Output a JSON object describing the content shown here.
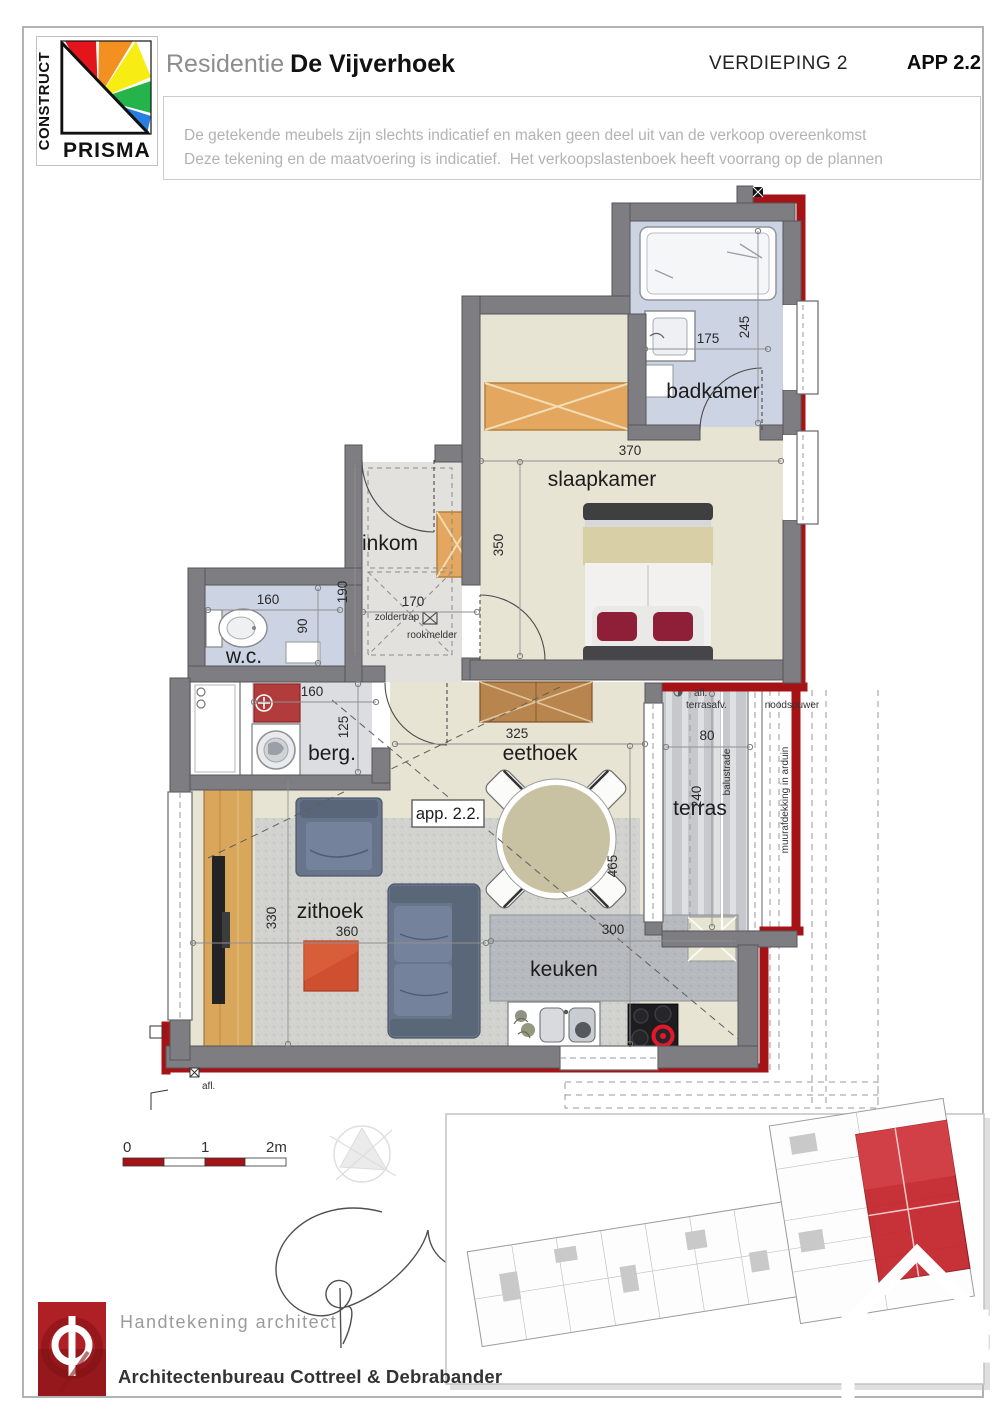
{
  "header": {
    "logo": {
      "construct": "CONSTRUCT",
      "prisma": "PRISMA"
    },
    "title_prefix": "Residentie",
    "title_name": "De Vijverhoek",
    "floor": "VERDIEPING 2",
    "apartment": "APP 2.2",
    "disclaimer_line1": "De getekende meubels zijn slechts indicatief en maken geen deel uit van de verkoop overeenkomst",
    "disclaimer_line2": "Deze tekening en de maatvoering is indicatief.  Het verkoopslastenboek heeft voorrang op de plannen"
  },
  "plan": {
    "apartment_tag": "app. 2.2.",
    "rooms": {
      "badkamer": "badkamer",
      "slaapkamer": "slaapkamer",
      "inkom": "inkom",
      "wc": "w.c.",
      "berg": "berg.",
      "eethoek": "eethoek",
      "terras": "terras",
      "zithoek": "zithoek",
      "keuken": "keuken"
    },
    "dims": {
      "badkamer_w": "175",
      "badkamer_d": "245",
      "slaapkamer_w": "370",
      "slaapkamer_d": "350",
      "inkom_d": "190",
      "inkom_w": "170",
      "wc_w": "160",
      "wc_d": "90",
      "berg_w": "160",
      "berg_d": "125",
      "eethoek_w": "325",
      "living_d": "465",
      "terras_w": "80",
      "terras_d": "240",
      "zithoek_d": "330",
      "zithoek_w": "360",
      "keuken_w": "300"
    },
    "annotations": {
      "zoldertrap": "zoldertrap",
      "rookmelder": "rookmelder",
      "balustrade": "balustrade",
      "muurafdekking": "muurafdekking in arduin",
      "noodspuwer": "noodspuwer",
      "afl_terras_1": "afl.",
      "afl_terras_2": "terrasafv.",
      "afl_bottom": "afl."
    }
  },
  "footer": {
    "scale": {
      "t0": "0",
      "t1": "1",
      "t2": "2m"
    },
    "signature_label": "Handtekening architect",
    "firm": "Architectenbureau Cottreel & Debrabander"
  },
  "colors": {
    "accent_red": "#a61316",
    "wall_gray": "#7d7d82",
    "floor_beige": "#e8e4d4",
    "floor_blue": "#ccd3e3",
    "wood_orange": "#e0a55f",
    "sofa_gray": "#67748a",
    "table_orange": "#cf5030",
    "logo_red": "#b01e24"
  }
}
